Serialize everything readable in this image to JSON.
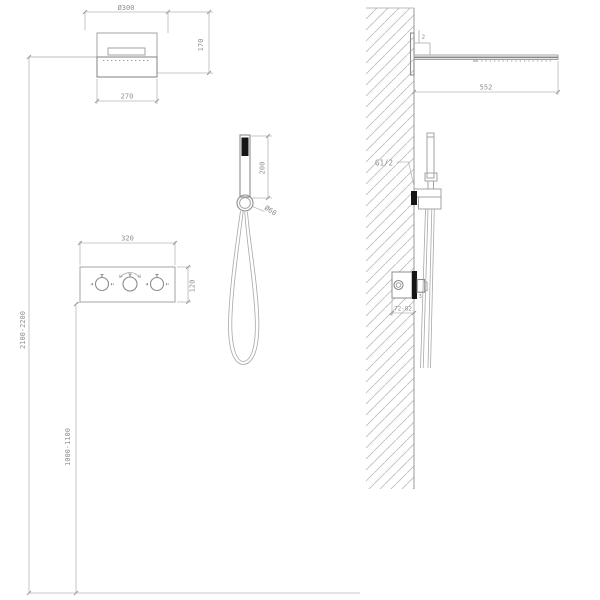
{
  "front_view": {
    "overhead_shower": {
      "diameter": "Ø300",
      "height": "170",
      "bottom_width": "270"
    },
    "mixer_panel": {
      "width": "320",
      "height": "120"
    },
    "hand_shower": {
      "length": "200",
      "holder_diameter": "Ø60"
    },
    "heights": {
      "overhead_install": "2100-2200",
      "mixer_install": "1000-1100"
    }
  },
  "side_view": {
    "overhead_shower": {
      "width": "552",
      "wall_step": "2"
    },
    "hand_shower": {
      "thread": "G1/2"
    },
    "mixer_valve": {
      "embed_depth": "72-82",
      "trim_thickness": "3"
    }
  },
  "colors": {
    "background": "#ffffff",
    "object_line": "#a3a3a3",
    "object_line_dark": "#8c8c8c",
    "dimension_line": "#b6b6b6",
    "text": "#8f8f8f",
    "wall_hatch": "#bcbcbc",
    "solid_black": "#161616"
  }
}
